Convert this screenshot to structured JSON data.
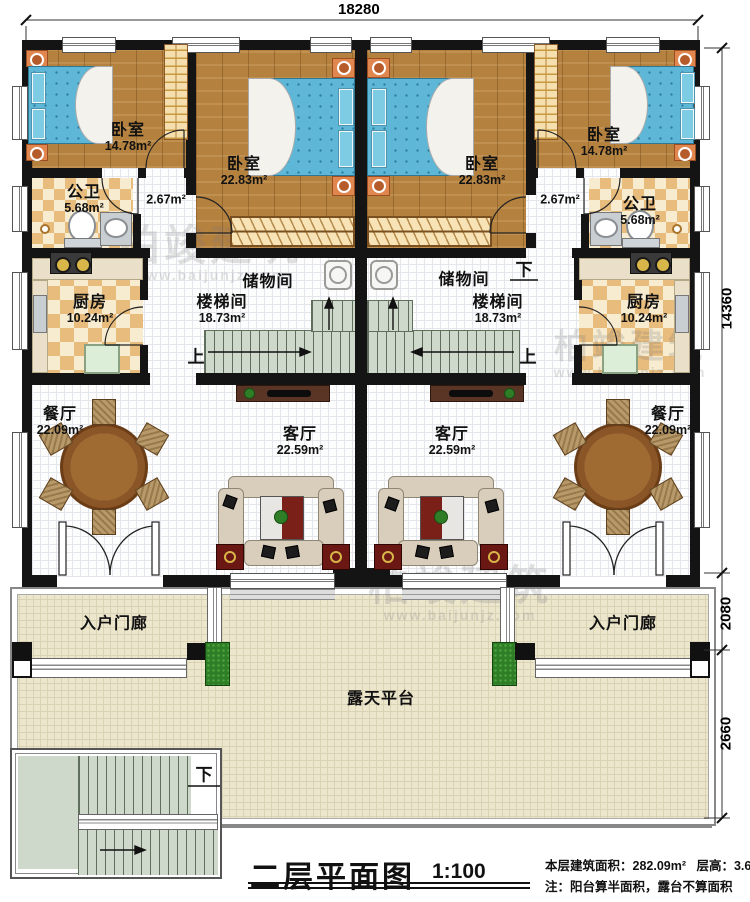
{
  "plan": {
    "title": "二层平面图",
    "scale": "1:100",
    "stats": {
      "area_label": "本层建筑面积：",
      "area_value": "282.09m²",
      "height_label": "层高：",
      "height_value": "3.6m",
      "note": "注：阳台算半面积，露台不算面积"
    },
    "dimensions": {
      "top_width": "18280",
      "right_main": "14360",
      "right_porch": "2080",
      "right_terrace": "2660"
    },
    "watermark": {
      "brand": "柏竣建筑",
      "url": "www.baijunjz.com"
    },
    "rooms": {
      "bedroom_small": {
        "name": "卧室",
        "area": "14.78m²"
      },
      "bedroom_large": {
        "name": "卧室",
        "area": "22.83m²"
      },
      "bathroom": {
        "name": "公卫",
        "area": "5.68m²"
      },
      "corridor": {
        "area": "2.67m²"
      },
      "kitchen": {
        "name": "厨房",
        "area": "10.24m²"
      },
      "storage": {
        "name": "储物间"
      },
      "stairwell": {
        "name": "楼梯间",
        "area": "18.73m²"
      },
      "dining": {
        "name": "餐厅",
        "area": "22.09m²"
      },
      "living": {
        "name": "客厅",
        "area": "22.59m²"
      },
      "porch": {
        "name": "入户门廊"
      },
      "terrace": {
        "name": "露天平台"
      }
    },
    "markers": {
      "up": "上",
      "down": "下"
    },
    "colors": {
      "wall": "#141414",
      "wood_floor": "#b5813f",
      "bed": "#5fb7d8",
      "tile": "#e7bc7c",
      "stair": "#cfd9cb",
      "terrace": "#ece6cd",
      "rug_red": "#7a2018",
      "planter": "#2f7d26"
    }
  }
}
